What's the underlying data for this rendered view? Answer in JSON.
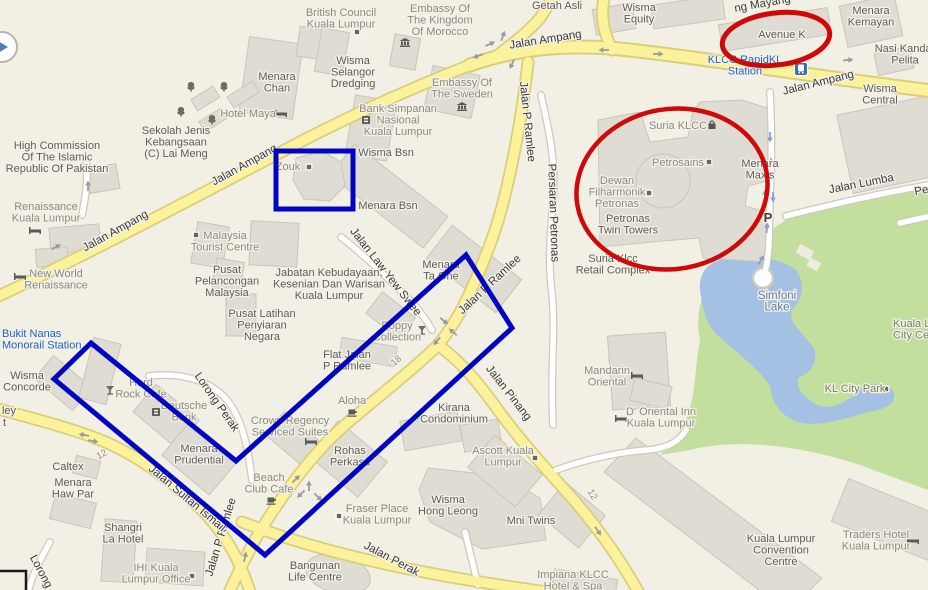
{
  "meta": {
    "width": 928,
    "height": 590,
    "app": "map-screenshot"
  },
  "annotations": {
    "red": "#cf0808",
    "blue": "#0104c2",
    "items": [
      "ellipse-avenue-k",
      "ellipse-klcc-complex",
      "rectangle-zouk",
      "polygon-southwest-blocks"
    ]
  },
  "labels": [
    {
      "n": "high-commission-pakistan",
      "l": [
        "High Commission",
        "Of The Islamic",
        "Republic Of Pakistan"
      ],
      "x": 57,
      "y": 149,
      "t": "place"
    },
    {
      "n": "sekolah-lai-meng",
      "l": [
        "Sekolah Jenis",
        "Kebangsaan",
        "(C) Lai Meng"
      ],
      "x": 176,
      "y": 134,
      "t": "place"
    },
    {
      "n": "menara-chan",
      "l": [
        "Menara",
        "Chan"
      ],
      "x": 277,
      "y": 80,
      "t": "place"
    },
    {
      "n": "hotel-maya",
      "l": [
        "Hotel Maya"
      ],
      "x": 248,
      "y": 117,
      "t": "minor"
    },
    {
      "n": "british-council",
      "l": [
        "British Council",
        "Kuala Lumpur"
      ],
      "x": 341,
      "y": 16,
      "t": "minor"
    },
    {
      "n": "wisma-selangor-dredging",
      "l": [
        "Wisma",
        "Selangor",
        "Dredging"
      ],
      "x": 353,
      "y": 64,
      "t": "place"
    },
    {
      "n": "embassy-morocco",
      "l": [
        "Embassy Of",
        "The Kingdom",
        "Of Morocco"
      ],
      "x": 440,
      "y": 12,
      "t": "minor"
    },
    {
      "n": "embassy-sweden",
      "l": [
        "Embassy Of",
        "The Sweden"
      ],
      "x": 462,
      "y": 86,
      "t": "minor"
    },
    {
      "n": "bank-simpanan",
      "l": [
        "Bank Simpanan",
        "Nasional",
        "Kuala Lumpur"
      ],
      "x": 398,
      "y": 112,
      "t": "minor"
    },
    {
      "n": "wisma-bsn",
      "l": [
        "Wisma Bsn"
      ],
      "x": 386,
      "y": 156,
      "t": "place"
    },
    {
      "n": "menara-bsn",
      "l": [
        "Menara Bsn"
      ],
      "x": 388,
      "y": 209,
      "t": "place"
    },
    {
      "n": "zouk",
      "l": [
        "Zouk"
      ],
      "x": 288,
      "y": 170,
      "t": "minor"
    },
    {
      "n": "getah-asli",
      "l": [
        "Getah Asli"
      ],
      "x": 557,
      "y": 9,
      "t": "place"
    },
    {
      "n": "wisma-equity",
      "l": [
        "Wisma",
        "Equity"
      ],
      "x": 639,
      "y": 11,
      "t": "place"
    },
    {
      "n": "avenue-k",
      "l": [
        "Avenue K"
      ],
      "x": 782,
      "y": 38,
      "t": "place"
    },
    {
      "n": "menara-kemayan",
      "l": [
        "Menara",
        "Kemayan"
      ],
      "x": 871,
      "y": 14,
      "t": "place"
    },
    {
      "n": "nasi-kandar-pelita",
      "l": [
        "Nasi Kandar",
        "Pelita"
      ],
      "x": 905,
      "y": 52,
      "t": "place"
    },
    {
      "n": "wisma-central",
      "l": [
        "Wisma",
        "Central"
      ],
      "x": 880,
      "y": 92,
      "t": "place"
    },
    {
      "n": "klcc-rapidkl-station",
      "l": [
        "KLCC RapidKL",
        "Station"
      ],
      "x": 745,
      "y": 63,
      "t": "transit"
    },
    {
      "n": "suria-klcc",
      "l": [
        "Suria KLCC"
      ],
      "x": 678,
      "y": 129,
      "t": "minor"
    },
    {
      "n": "petrosains",
      "l": [
        "Petrosains"
      ],
      "x": 678,
      "y": 166,
      "t": "minor"
    },
    {
      "n": "menara-maxis",
      "l": [
        "Menara",
        "Maxis"
      ],
      "x": 760,
      "y": 167,
      "t": "place"
    },
    {
      "n": "dewan-filharmonik",
      "l": [
        "Dewan",
        "Filharmonik",
        "Petronas"
      ],
      "x": 617,
      "y": 184,
      "t": "minor"
    },
    {
      "n": "petronas-twin-towers",
      "l": [
        "Petronas",
        "Twin Towers"
      ],
      "x": 628,
      "y": 222,
      "t": "place"
    },
    {
      "n": "suria-klcc-retail-complex",
      "l": [
        "Suria Klcc",
        "Retail Complex"
      ],
      "x": 613,
      "y": 262,
      "t": "place"
    },
    {
      "n": "parking",
      "l": [
        "P"
      ],
      "x": 768,
      "y": 222,
      "t": "parking"
    },
    {
      "n": "renaissance-kl",
      "l": [
        "Renaissance",
        "Kuala Lumpur"
      ],
      "x": 46,
      "y": 210,
      "t": "minor"
    },
    {
      "n": "new-world-renaissance",
      "l": [
        "New World",
        "Renaissance"
      ],
      "x": 56,
      "y": 277,
      "t": "minor"
    },
    {
      "n": "malaysia-tourist-centre",
      "l": [
        "Malaysia",
        "Tourist Centre"
      ],
      "x": 225,
      "y": 239,
      "t": "minor"
    },
    {
      "n": "pusat-pelancongan",
      "l": [
        "Pusat",
        "Pelancongan",
        "Malaysia"
      ],
      "x": 227,
      "y": 273,
      "t": "place"
    },
    {
      "n": "pusat-latihan",
      "l": [
        "Pusat Latihan",
        "Penyiaran",
        "Negara"
      ],
      "x": 262,
      "y": 317,
      "t": "place"
    },
    {
      "n": "jabatan-kebudayaan",
      "l": [
        "Jabatan Kebudayaan,",
        "Kesenian Dan Warisan",
        "Kuala Lumpur"
      ],
      "x": 329,
      "y": 276,
      "t": "place"
    },
    {
      "n": "menara-ta-one",
      "l": [
        "Menara",
        "Ta One"
      ],
      "x": 441,
      "y": 268,
      "t": "place"
    },
    {
      "n": "simfoni-lake",
      "l": [
        "Simfoni",
        "Lake"
      ],
      "x": 777,
      "y": 299,
      "t": "water"
    },
    {
      "n": "klcc-park",
      "l": [
        "Kuala Lumpur",
        "City Centre"
      ],
      "x": 893,
      "y": 327,
      "t": "park",
      "a": "s"
    },
    {
      "n": "kl-city-park",
      "l": [
        "KL City Park"
      ],
      "x": 855,
      "y": 392,
      "t": "park"
    },
    {
      "n": "bukit-nanas-monorail-station",
      "l": [
        "Bukit Nanas",
        "Monorail Station"
      ],
      "x": 2,
      "y": 337,
      "t": "transit",
      "a": "s"
    },
    {
      "n": "wisma-concorde",
      "l": [
        "Wisma",
        "Concorde"
      ],
      "x": 27,
      "y": 379,
      "t": "place"
    },
    {
      "n": "hard-rock-cafe",
      "l": [
        "Hard",
        "Rock Cafe"
      ],
      "x": 141,
      "y": 386,
      "t": "minor"
    },
    {
      "n": "deutsche-bank",
      "l": [
        "Deutsche",
        "Bank"
      ],
      "x": 184,
      "y": 409,
      "t": "minor"
    },
    {
      "n": "menara-prudential",
      "l": [
        "Menara",
        "Prudential"
      ],
      "x": 199,
      "y": 452,
      "t": "place"
    },
    {
      "n": "crown-regency",
      "l": [
        "Crown Regency",
        "Serviced Suites"
      ],
      "x": 290,
      "y": 424,
      "t": "minor"
    },
    {
      "n": "beach-club-cafe",
      "l": [
        "Beach",
        "Club Cafe"
      ],
      "x": 269,
      "y": 481,
      "t": "minor"
    },
    {
      "n": "poppy-collection",
      "l": [
        "Poppy",
        "Collection"
      ],
      "x": 397,
      "y": 329,
      "t": "minor"
    },
    {
      "n": "flat-jalan-p-ramlee",
      "l": [
        "Flat Jalan",
        "P Ramlee"
      ],
      "x": 347,
      "y": 358,
      "t": "place"
    },
    {
      "n": "aloha",
      "l": [
        "Aloha"
      ],
      "x": 352,
      "y": 404,
      "t": "minor"
    },
    {
      "n": "kirana-condominium",
      "l": [
        "Kirana",
        "Condominium"
      ],
      "x": 454,
      "y": 411,
      "t": "place"
    },
    {
      "n": "caltex",
      "l": [
        "Caltex"
      ],
      "x": 68,
      "y": 470,
      "t": "place"
    },
    {
      "n": "menara-haw-par",
      "l": [
        "Menara",
        "Haw Par"
      ],
      "x": 73,
      "y": 486,
      "t": "place"
    },
    {
      "n": "shangri-la-hotel",
      "l": [
        "Shangri",
        "La Hotel"
      ],
      "x": 123,
      "y": 531,
      "t": "place"
    },
    {
      "n": "ihi-kuala-lumpur-office",
      "l": [
        "IHI Kuala",
        "Lumpur Office"
      ],
      "x": 156,
      "y": 571,
      "t": "minor"
    },
    {
      "n": "bangunan-life-centre",
      "l": [
        "Bangunan",
        "Life Centre"
      ],
      "x": 315,
      "y": 569,
      "t": "place"
    },
    {
      "n": "rohas-perkasa",
      "l": [
        "Rohas",
        "Perkasa"
      ],
      "x": 350,
      "y": 454,
      "t": "place"
    },
    {
      "n": "fraser-place",
      "l": [
        "Fraser Place",
        "Kuala Lumpur"
      ],
      "x": 377,
      "y": 512,
      "t": "minor"
    },
    {
      "n": "wisma-hong-leong",
      "l": [
        "Wisma",
        "Hong Leong"
      ],
      "x": 448,
      "y": 503,
      "t": "place"
    },
    {
      "n": "ascott-kuala-lumpur",
      "l": [
        "Ascott Kuala",
        "Lumpur"
      ],
      "x": 503,
      "y": 454,
      "t": "minor"
    },
    {
      "n": "mni-twins",
      "l": [
        "Mni Twins"
      ],
      "x": 531,
      "y": 524,
      "t": "place"
    },
    {
      "n": "mandarin-oriental",
      "l": [
        "Mandarin",
        "Oriental"
      ],
      "x": 607,
      "y": 374,
      "t": "minor"
    },
    {
      "n": "d-oriental-inn",
      "l": [
        "D' Oriental Inn",
        "Kuala Lumpur"
      ],
      "x": 661,
      "y": 415,
      "t": "minor"
    },
    {
      "n": "impiana-klcc",
      "l": [
        "Impiana KLCC",
        "Hotel & Spa"
      ],
      "x": 573,
      "y": 578,
      "t": "minor"
    },
    {
      "n": "kl-convention-centre",
      "l": [
        "Kuala Lumpur",
        "Convention",
        "Centre"
      ],
      "x": 781,
      "y": 542,
      "t": "place"
    },
    {
      "n": "traders-hotel",
      "l": [
        "Traders Hotel",
        "Kuala Lumpur"
      ],
      "x": 876,
      "y": 538,
      "t": "minor"
    },
    {
      "n": "edge-partial-ley",
      "l": [
        "ley"
      ],
      "x": 16,
      "y": 414,
      "t": "place",
      "a": "e"
    },
    {
      "n": "edge-partial-t",
      "l": [
        "t"
      ],
      "x": 6,
      "y": 426,
      "t": "place",
      "a": "e"
    },
    {
      "n": "road-jalan-ampang-w1",
      "l": [
        "Jalan Ampang"
      ],
      "x": 117,
      "y": 234,
      "r": -29,
      "t": "road"
    },
    {
      "n": "road-jalan-ampang-w2",
      "l": [
        "Jalan Ampang"
      ],
      "x": 246,
      "y": 168,
      "r": -29,
      "t": "road"
    },
    {
      "n": "road-jalan-ampang-c",
      "l": [
        "Jalan Ampang"
      ],
      "x": 546,
      "y": 43,
      "r": -9,
      "t": "road"
    },
    {
      "n": "road-jalan-ampang-e",
      "l": [
        "Jalan Ampang"
      ],
      "x": 819,
      "y": 86,
      "r": -14,
      "t": "road"
    },
    {
      "n": "road-jalan-p-ramlee-n",
      "l": [
        "Jalan P Ramlee"
      ],
      "x": 524,
      "y": 122,
      "r": 84,
      "t": "road"
    },
    {
      "n": "road-jalan-p-ramlee-m",
      "l": [
        "Jalan P Ramlee"
      ],
      "x": 492,
      "y": 287,
      "r": -43,
      "t": "road"
    },
    {
      "n": "road-jalan-p-ramlee-s",
      "l": [
        "Jalan P Ramlee"
      ],
      "x": 224,
      "y": 538,
      "r": -73,
      "t": "road"
    },
    {
      "n": "road-jalan-sultan-ismail",
      "l": [
        "Jalan Sultan Ismail"
      ],
      "x": 185,
      "y": 501,
      "r": 40,
      "t": "road"
    },
    {
      "n": "road-jalan-pinang",
      "l": [
        "Jalan Pinang"
      ],
      "x": 506,
      "y": 395,
      "r": 52,
      "t": "road"
    },
    {
      "n": "road-jalan-perak",
      "l": [
        "Jalan Perak"
      ],
      "x": 390,
      "y": 562,
      "r": 28,
      "t": "road"
    },
    {
      "n": "road-persiaran-petronas",
      "l": [
        "Persiaran Petronas"
      ],
      "x": 550,
      "y": 213,
      "r": 88,
      "t": "road"
    },
    {
      "n": "road-jalan-lumba",
      "l": [
        "Jalan Lumba"
      ],
      "x": 862,
      "y": 187,
      "r": -11,
      "t": "road"
    },
    {
      "n": "road-jalan-law-yew-swee",
      "l": [
        "Jalan Law Yew Swee"
      ],
      "x": 383,
      "y": 274,
      "r": 52,
      "t": "road"
    },
    {
      "n": "road-lorong-perak",
      "l": [
        "Lorong Perak"
      ],
      "x": 214,
      "y": 404,
      "r": 55,
      "t": "road"
    },
    {
      "n": "road-lorong-partial",
      "l": [
        "Lorong"
      ],
      "x": 38,
      "y": 573,
      "r": 62,
      "t": "road"
    },
    {
      "n": "road-mayang-partial",
      "l": [
        "ng Mayang"
      ],
      "x": 763,
      "y": 7,
      "r": -10,
      "t": "road"
    },
    {
      "n": "road-pe-partial",
      "l": [
        "Pe"
      ],
      "x": 922,
      "y": 194,
      "r": -11,
      "t": "road"
    },
    {
      "n": "route-12-a",
      "l": [
        "12"
      ],
      "x": 103,
      "y": 457,
      "r": -28,
      "t": "route"
    },
    {
      "n": "route-18",
      "l": [
        "18"
      ],
      "x": 398,
      "y": 363,
      "r": -40,
      "t": "route"
    },
    {
      "n": "route-12-b",
      "l": [
        "12"
      ],
      "x": 590,
      "y": 496,
      "r": 60,
      "t": "route"
    }
  ],
  "icons": [
    {
      "k": "bed",
      "x": 35,
      "y": 231
    },
    {
      "k": "bed",
      "x": 20,
      "y": 277
    },
    {
      "k": "bed",
      "x": 281,
      "y": 114
    },
    {
      "k": "bed",
      "x": 311,
      "y": 442
    },
    {
      "k": "bed",
      "x": 637,
      "y": 376
    },
    {
      "k": "bed",
      "x": 621,
      "y": 419
    },
    {
      "k": "bed",
      "x": 913,
      "y": 541
    },
    {
      "k": "museum",
      "x": 405,
      "y": 43
    },
    {
      "k": "museum",
      "x": 462,
      "y": 107
    },
    {
      "k": "bank",
      "x": 366,
      "y": 120
    },
    {
      "k": "bank",
      "x": 156,
      "y": 412
    },
    {
      "k": "cocktail",
      "x": 422,
      "y": 330
    },
    {
      "k": "cocktail",
      "x": 110,
      "y": 390
    },
    {
      "k": "coffee",
      "x": 271,
      "y": 500
    },
    {
      "k": "coffee",
      "x": 352,
      "y": 412
    },
    {
      "k": "shopping-bag",
      "x": 712,
      "y": 125
    },
    {
      "k": "train-station",
      "x": 801,
      "y": 69
    },
    {
      "k": "square-marker",
      "x": 357,
      "y": 32
    },
    {
      "k": "square-marker",
      "x": 309,
      "y": 167
    },
    {
      "k": "square-marker",
      "x": 196,
      "y": 235
    },
    {
      "k": "square-marker",
      "x": 709,
      "y": 162
    },
    {
      "k": "square-marker",
      "x": 649,
      "y": 193
    },
    {
      "k": "square-marker",
      "x": 339,
      "y": 516
    },
    {
      "k": "square-marker",
      "x": 535,
      "y": 458
    },
    {
      "k": "square-marker",
      "x": 886,
      "y": 389
    },
    {
      "k": "square-marker",
      "x": 192,
      "y": 576
    },
    {
      "k": "tree",
      "x": 191,
      "y": 87
    },
    {
      "k": "tree",
      "x": 224,
      "y": 87
    },
    {
      "k": "tree",
      "x": 181,
      "y": 112
    },
    {
      "k": "tree",
      "x": 212,
      "y": 120
    },
    {
      "k": "arrow",
      "x": 56,
      "y": 247,
      "r": -28,
      "c": "gray"
    },
    {
      "k": "arrow",
      "x": 84,
      "y": 435,
      "r": 190,
      "c": "gray"
    },
    {
      "k": "arrow",
      "x": 93,
      "y": 441,
      "r": 10,
      "c": "gray"
    },
    {
      "k": "arrow",
      "x": 604,
      "y": 50,
      "r": 180,
      "c": "gray"
    },
    {
      "k": "arrow",
      "x": 658,
      "y": 54,
      "r": 0,
      "c": "gray"
    },
    {
      "k": "arrow",
      "x": 848,
      "y": 60,
      "r": -5,
      "c": "gray"
    },
    {
      "k": "arrow",
      "x": 490,
      "y": 44,
      "r": -25,
      "c": "gray"
    },
    {
      "k": "arrow",
      "x": 478,
      "y": 56,
      "r": 160,
      "c": "gray"
    },
    {
      "k": "arrow",
      "x": 503,
      "y": 36,
      "r": -70,
      "c": "gray"
    },
    {
      "k": "arrow",
      "x": 512,
      "y": 64,
      "r": 115,
      "c": "gray"
    },
    {
      "k": "arrow",
      "x": 444,
      "y": 321,
      "r": 40,
      "c": "gray"
    },
    {
      "k": "arrow",
      "x": 453,
      "y": 332,
      "r": 220,
      "c": "gray"
    },
    {
      "k": "arrow",
      "x": 437,
      "y": 341,
      "r": 130,
      "c": "gray"
    },
    {
      "k": "arrow",
      "x": 296,
      "y": 479,
      "r": -45,
      "c": "gray"
    },
    {
      "k": "arrow",
      "x": 309,
      "y": 486,
      "r": -90,
      "c": "gray"
    },
    {
      "k": "arrow",
      "x": 301,
      "y": 494,
      "r": 135,
      "c": "gray"
    },
    {
      "k": "arrow",
      "x": 318,
      "y": 497,
      "r": 45,
      "c": "gray"
    },
    {
      "k": "arrow",
      "x": 245,
      "y": 557,
      "r": -78,
      "c": "gray"
    },
    {
      "k": "arrow",
      "x": 598,
      "y": 531,
      "r": 55,
      "c": "gray"
    },
    {
      "k": "arrow",
      "x": 88,
      "y": 186,
      "r": -90,
      "c": "gray"
    },
    {
      "k": "arrow",
      "x": 770,
      "y": 137,
      "r": 90,
      "c": "blue"
    },
    {
      "k": "arrow",
      "x": 771,
      "y": 163,
      "r": 90,
      "c": "blue"
    },
    {
      "k": "arrow",
      "x": 765,
      "y": 195,
      "r": -90,
      "c": "blue"
    },
    {
      "k": "arrow",
      "x": 773,
      "y": 197,
      "r": 90,
      "c": "blue"
    },
    {
      "k": "arrow",
      "x": 767,
      "y": 228,
      "r": -85,
      "c": "blue"
    },
    {
      "k": "arrow",
      "x": 761,
      "y": 260,
      "r": -60,
      "c": "blue"
    }
  ]
}
